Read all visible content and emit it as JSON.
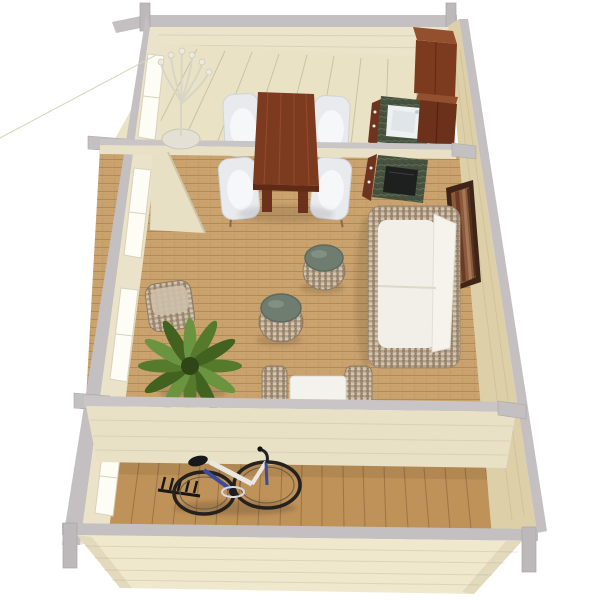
{
  "scene": {
    "title": "3D top-down floor plan render of a wooden garden house",
    "view": "dollhouse cutaway perspective, no text labels",
    "background": "#ffffff",
    "rooms": [
      {
        "name": "kitchen-dining-room",
        "position": "top",
        "furniture": [
          "twig floor lamp",
          "mahogany dining table",
          "four white tub chairs",
          "tall mahogany cabinet",
          "green marble counter with white sink"
        ]
      },
      {
        "name": "living-room",
        "position": "middle",
        "furniture": [
          "green marble counter with black cooktop",
          "wall picture",
          "wicker sofa with white cushions",
          "two round wicker stools with green tops",
          "square wicker pouf",
          "potted fern",
          "white coffee table",
          "two wicker poufs",
          "open door"
        ]
      },
      {
        "name": "terrace-room",
        "position": "bottom",
        "furniture": [
          "city bicycle",
          "dark garden tool"
        ]
      }
    ]
  },
  "colors": {
    "background": "#ffffff",
    "wall_edge_gray": "#c4c0c1",
    "post_gray": "#bdb9ba",
    "wall_cream": "#ebe3c9",
    "back_wall_face": "#ece4ca",
    "right_wall_face": "#ddd0a8",
    "partition_face": "#e9e1c6",
    "front_wall_face": "#f0e8cd",
    "kitchen_floor": "#eae2c5",
    "living_floor": "#c59a63",
    "terrace_floor": "#bf9259",
    "door_panel": "#e8e0c4",
    "window_white": "#fdfdf6",
    "mahogany": "#7c3a1f",
    "mahogany_top": "#94502e",
    "mahogany_dark": "#6b311b",
    "cabinet_base_brown": "#6e3420",
    "counter_green": "#46523f",
    "cooktop_black": "#1d201f",
    "sink_white": "#eef1f2",
    "chair_white": "#e9eaed",
    "cushion_white": "#f1efe8",
    "sofa_back_white": "#f5f3ec",
    "wicker_base": "#b4a28b",
    "stool_top_green": "#6f7d71",
    "stool_top_dark": "#5c6a60",
    "square_pouf_top": "#cdbfa8",
    "plant_green": "#567a2c",
    "plant_light": "#6b9440",
    "plant_dark": "#42621f",
    "coffee_table_white": "#f3f2ec",
    "frame_brown": "#3f2517",
    "art_base": "#8a5a3a",
    "lamp_cream": "#d9d5c6",
    "lamp_base": "#e4e1d4",
    "bike_dark": "#24211e",
    "bike_white": "#e9e7e1",
    "bike_blue": "#3b4b9e"
  }
}
